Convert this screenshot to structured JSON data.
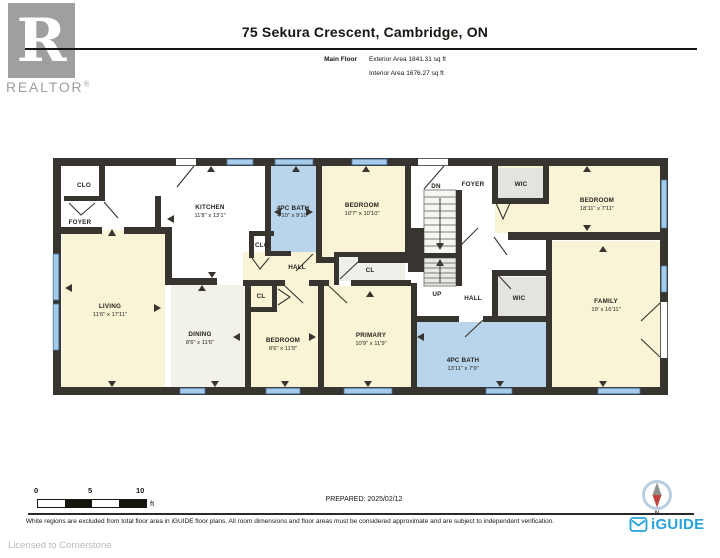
{
  "header": {
    "logo_letter": "R",
    "logo_word": "REALTOR",
    "logo_reg": "®",
    "address": "75 Sekura Crescent, Cambridge, ON",
    "floor_name": "Main Floor",
    "exterior_area": "Exterior Area 1841.31 sq ft",
    "interior_area": "Interior Area 1676.27 sq ft"
  },
  "plan": {
    "rooms": [
      {
        "name": "CLO",
        "dims": ""
      },
      {
        "name": "FOYER",
        "dims": ""
      },
      {
        "name": "KITCHEN",
        "dims": "11'8\" x 13'1\""
      },
      {
        "name": "4PC BATH",
        "dims": "4'10\" x 9'10\""
      },
      {
        "name": "CLO",
        "dims": ""
      },
      {
        "name": "BEDROOM",
        "dims": "10'7\" x 10'10\""
      },
      {
        "name": "DN",
        "dims": ""
      },
      {
        "name": "FOYER",
        "dims": ""
      },
      {
        "name": "WIC",
        "dims": ""
      },
      {
        "name": "BEDROOM",
        "dims": "18'11\" x 7'11\""
      },
      {
        "name": "LIVING",
        "dims": "11'6\" x 17'11\""
      },
      {
        "name": "DINING",
        "dims": "8'6\" x 11'6\""
      },
      {
        "name": "HALL",
        "dims": ""
      },
      {
        "name": "CL",
        "dims": ""
      },
      {
        "name": "CL",
        "dims": ""
      },
      {
        "name": "BEDROOM",
        "dims": "8'6\" x 11'9\""
      },
      {
        "name": "PRIMARY",
        "dims": "10'9\" x 11'9\""
      },
      {
        "name": "UP",
        "dims": ""
      },
      {
        "name": "HALL",
        "dims": ""
      },
      {
        "name": "WIC",
        "dims": ""
      },
      {
        "name": "4PC BATH",
        "dims": "13'11\" x 7'9\""
      },
      {
        "name": "FAMILY",
        "dims": "19' x 16'11\""
      }
    ]
  },
  "footer": {
    "scale_zero": "0",
    "scale_five": "5",
    "scale_ten": "10",
    "scale_unit": "ft",
    "prepared": "PREPARED: 2025/02/12",
    "compass_label": "N",
    "brand": "iGUIDE",
    "disclaimer": "White regions are excluded from total floor area in iGUIDE floor plans. All room dimensions and floor areas must be considered approximate and are subject to independent verification.",
    "license": "Licensed to Cornerstone"
  },
  "colors": {
    "room_cream": "#f9f4d5",
    "bath_blue": "#b8d5ec",
    "closet_gray": "#e3e3df",
    "wall": "#38342f",
    "window_blue": "#a6cbe9",
    "brand_blue": "#25a3da",
    "compass_red": "#c2413a",
    "logo_gray": "#9f9f9f"
  }
}
